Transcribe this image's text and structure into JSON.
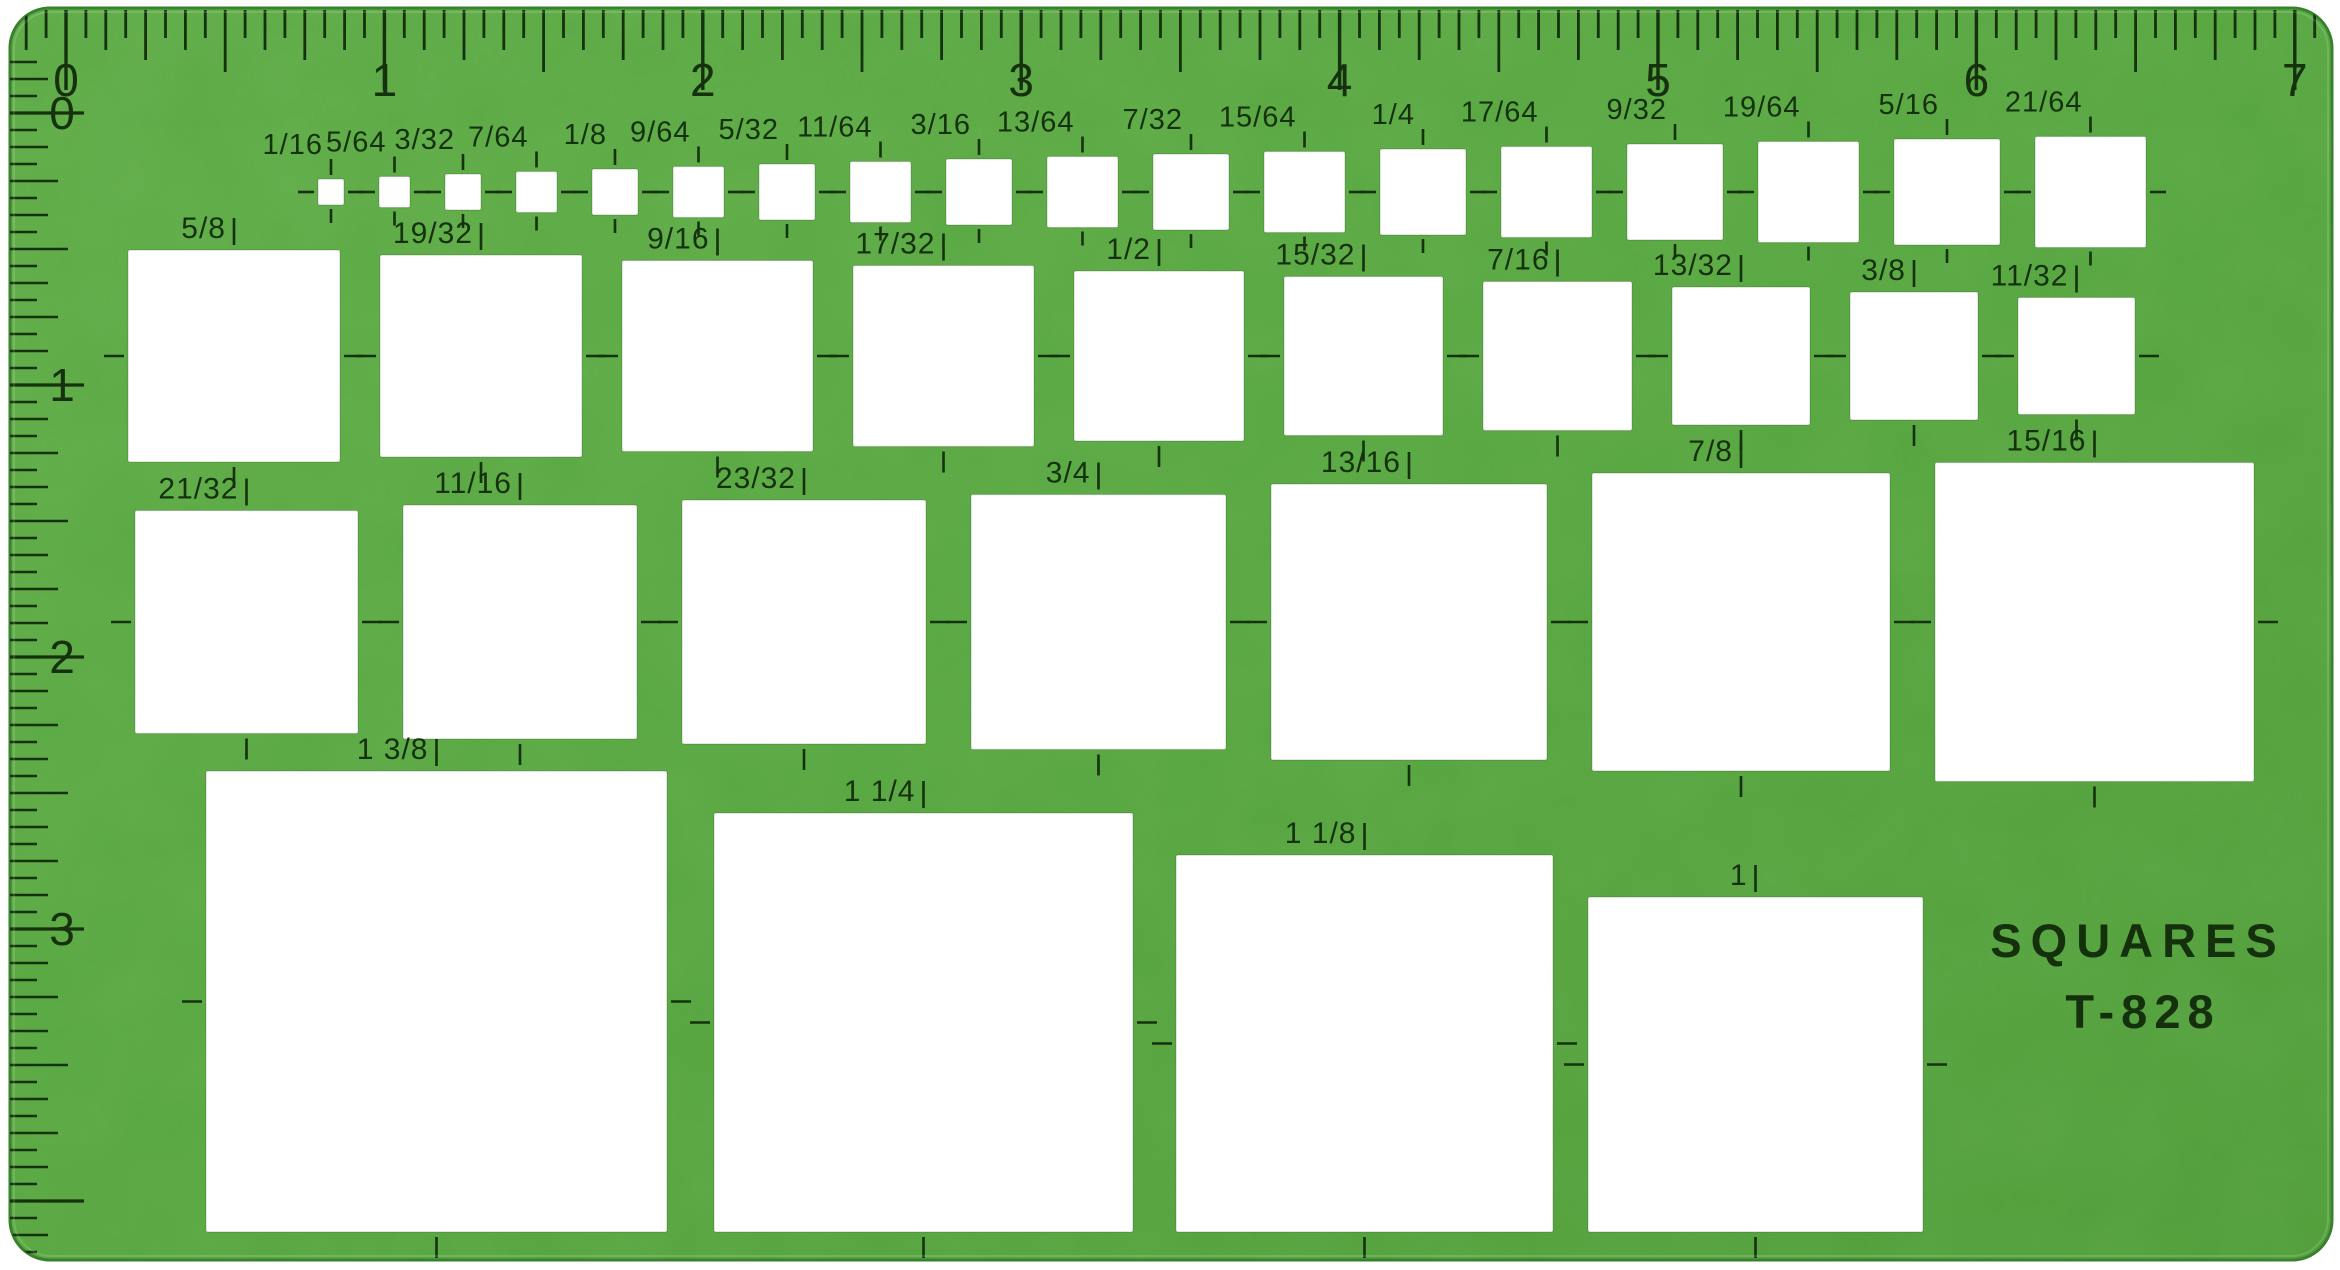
{
  "product": {
    "title": "SQUARES",
    "model": "T-828"
  },
  "colors": {
    "body_green": "#58a740",
    "body_green_light": "#61af4a",
    "body_green_dark": "#4f9c38",
    "edge": "#35812a",
    "ink": "#15310d",
    "cutout": "#ffffff",
    "page_bg": "#ffffff"
  },
  "top_ruler": {
    "labels": [
      "0",
      "1",
      "2",
      "3",
      "4",
      "5",
      "6",
      "7"
    ],
    "origin_x": 66,
    "px_per_inch": 318.4,
    "number_y": 96
  },
  "left_ruler": {
    "labels": [
      "0",
      "1",
      "2",
      "3"
    ],
    "origin_y": 113,
    "px_per_inch": 272,
    "number_x": 62
  },
  "rows": [
    {
      "name": "row-64ths",
      "center_y": 192,
      "start_x": 318,
      "gap": 35,
      "label_style": "small",
      "squares": [
        {
          "label": "1/16",
          "size": 26
        },
        {
          "label": "5/64",
          "size": 31
        },
        {
          "label": "3/32",
          "size": 36
        },
        {
          "label": "7/64",
          "size": 41
        },
        {
          "label": "1/8",
          "size": 46
        },
        {
          "label": "9/64",
          "size": 51
        },
        {
          "label": "5/32",
          "size": 56
        },
        {
          "label": "11/64",
          "size": 61
        },
        {
          "label": "3/16",
          "size": 66
        },
        {
          "label": "13/64",
          "size": 71
        },
        {
          "label": "7/32",
          "size": 76
        },
        {
          "label": "15/64",
          "size": 81
        },
        {
          "label": "1/4",
          "size": 86
        },
        {
          "label": "17/64",
          "size": 91
        },
        {
          "label": "9/32",
          "size": 96
        },
        {
          "label": "19/64",
          "size": 101
        },
        {
          "label": "5/16",
          "size": 106
        },
        {
          "label": "21/64",
          "size": 111
        }
      ]
    },
    {
      "name": "row-upper-32nds",
      "center_y": 356,
      "start_x": 128,
      "gap": 40,
      "label_style": "large",
      "squares": [
        {
          "label": "5/8",
          "size": 212
        },
        {
          "label": "19/32",
          "size": 202
        },
        {
          "label": "9/16",
          "size": 191
        },
        {
          "label": "17/32",
          "size": 181
        },
        {
          "label": "1/2",
          "size": 170
        },
        {
          "label": "15/32",
          "size": 159
        },
        {
          "label": "7/16",
          "size": 149
        },
        {
          "label": "13/32",
          "size": 138
        },
        {
          "label": "3/8",
          "size": 128
        },
        {
          "label": "11/32",
          "size": 117
        }
      ]
    },
    {
      "name": "row-lower-32nds",
      "center_y": 622,
      "start_x": 135,
      "gap": 45,
      "label_style": "large",
      "squares": [
        {
          "label": "21/32",
          "size": 223
        },
        {
          "label": "11/16",
          "size": 234
        },
        {
          "label": "23/32",
          "size": 244
        },
        {
          "label": "3/4",
          "size": 255
        },
        {
          "label": "13/16",
          "size": 276
        },
        {
          "label": "7/8",
          "size": 298
        },
        {
          "label": "15/16",
          "size": 319
        }
      ]
    },
    {
      "name": "row-inches",
      "bottom_y": 1232,
      "xs": [
        206,
        714,
        1176,
        1588
      ],
      "label_style": "large",
      "squares": [
        {
          "label": "1 3/8",
          "size": 461
        },
        {
          "label": "1 1/4",
          "size": 419
        },
        {
          "label": "1 1/8",
          "size": 377
        },
        {
          "label": "1",
          "size": 335
        }
      ]
    }
  ]
}
